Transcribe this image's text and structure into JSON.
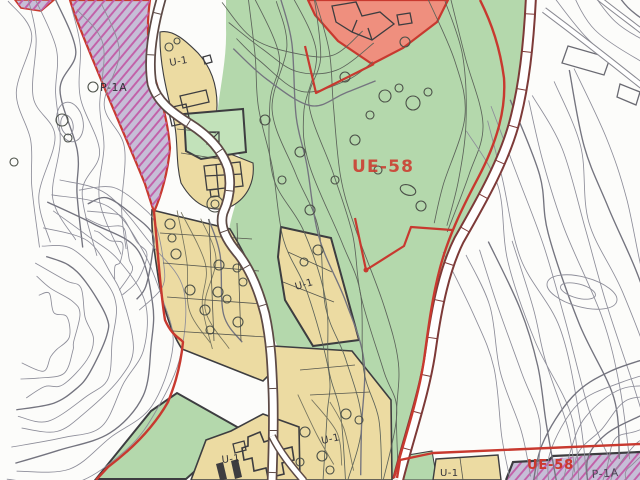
{
  "map": {
    "labels": {
      "p1a_top": "P-1A",
      "u1_top": "U-1",
      "ue58_main": "UE-58",
      "u1_mid": "U-1",
      "u1_bottom_left": "U-1",
      "u1_bottom_mid": "U-1",
      "u1_bottom_right": "U-1",
      "ue58_bottom": "UE-58",
      "p1a_bottom": "P-1A"
    },
    "zone_colors": {
      "green": "#b4d8ac",
      "green_light": "#c2e2ba",
      "yellow": "#ecdba2",
      "salmon": "#ef8f7e",
      "purple_fill": "#c6bed7",
      "purple_stripe": "#c25fa8",
      "boundary_red": "#c8392f",
      "road_maroon": "#7d3a38",
      "road_gray": "#5d4a46",
      "contour_gray": "#8d8d99",
      "contour_dark": "#5c635a",
      "line_dark": "#3d3d40",
      "label_red": "#cc392e",
      "label_dark": "#33333a"
    }
  }
}
